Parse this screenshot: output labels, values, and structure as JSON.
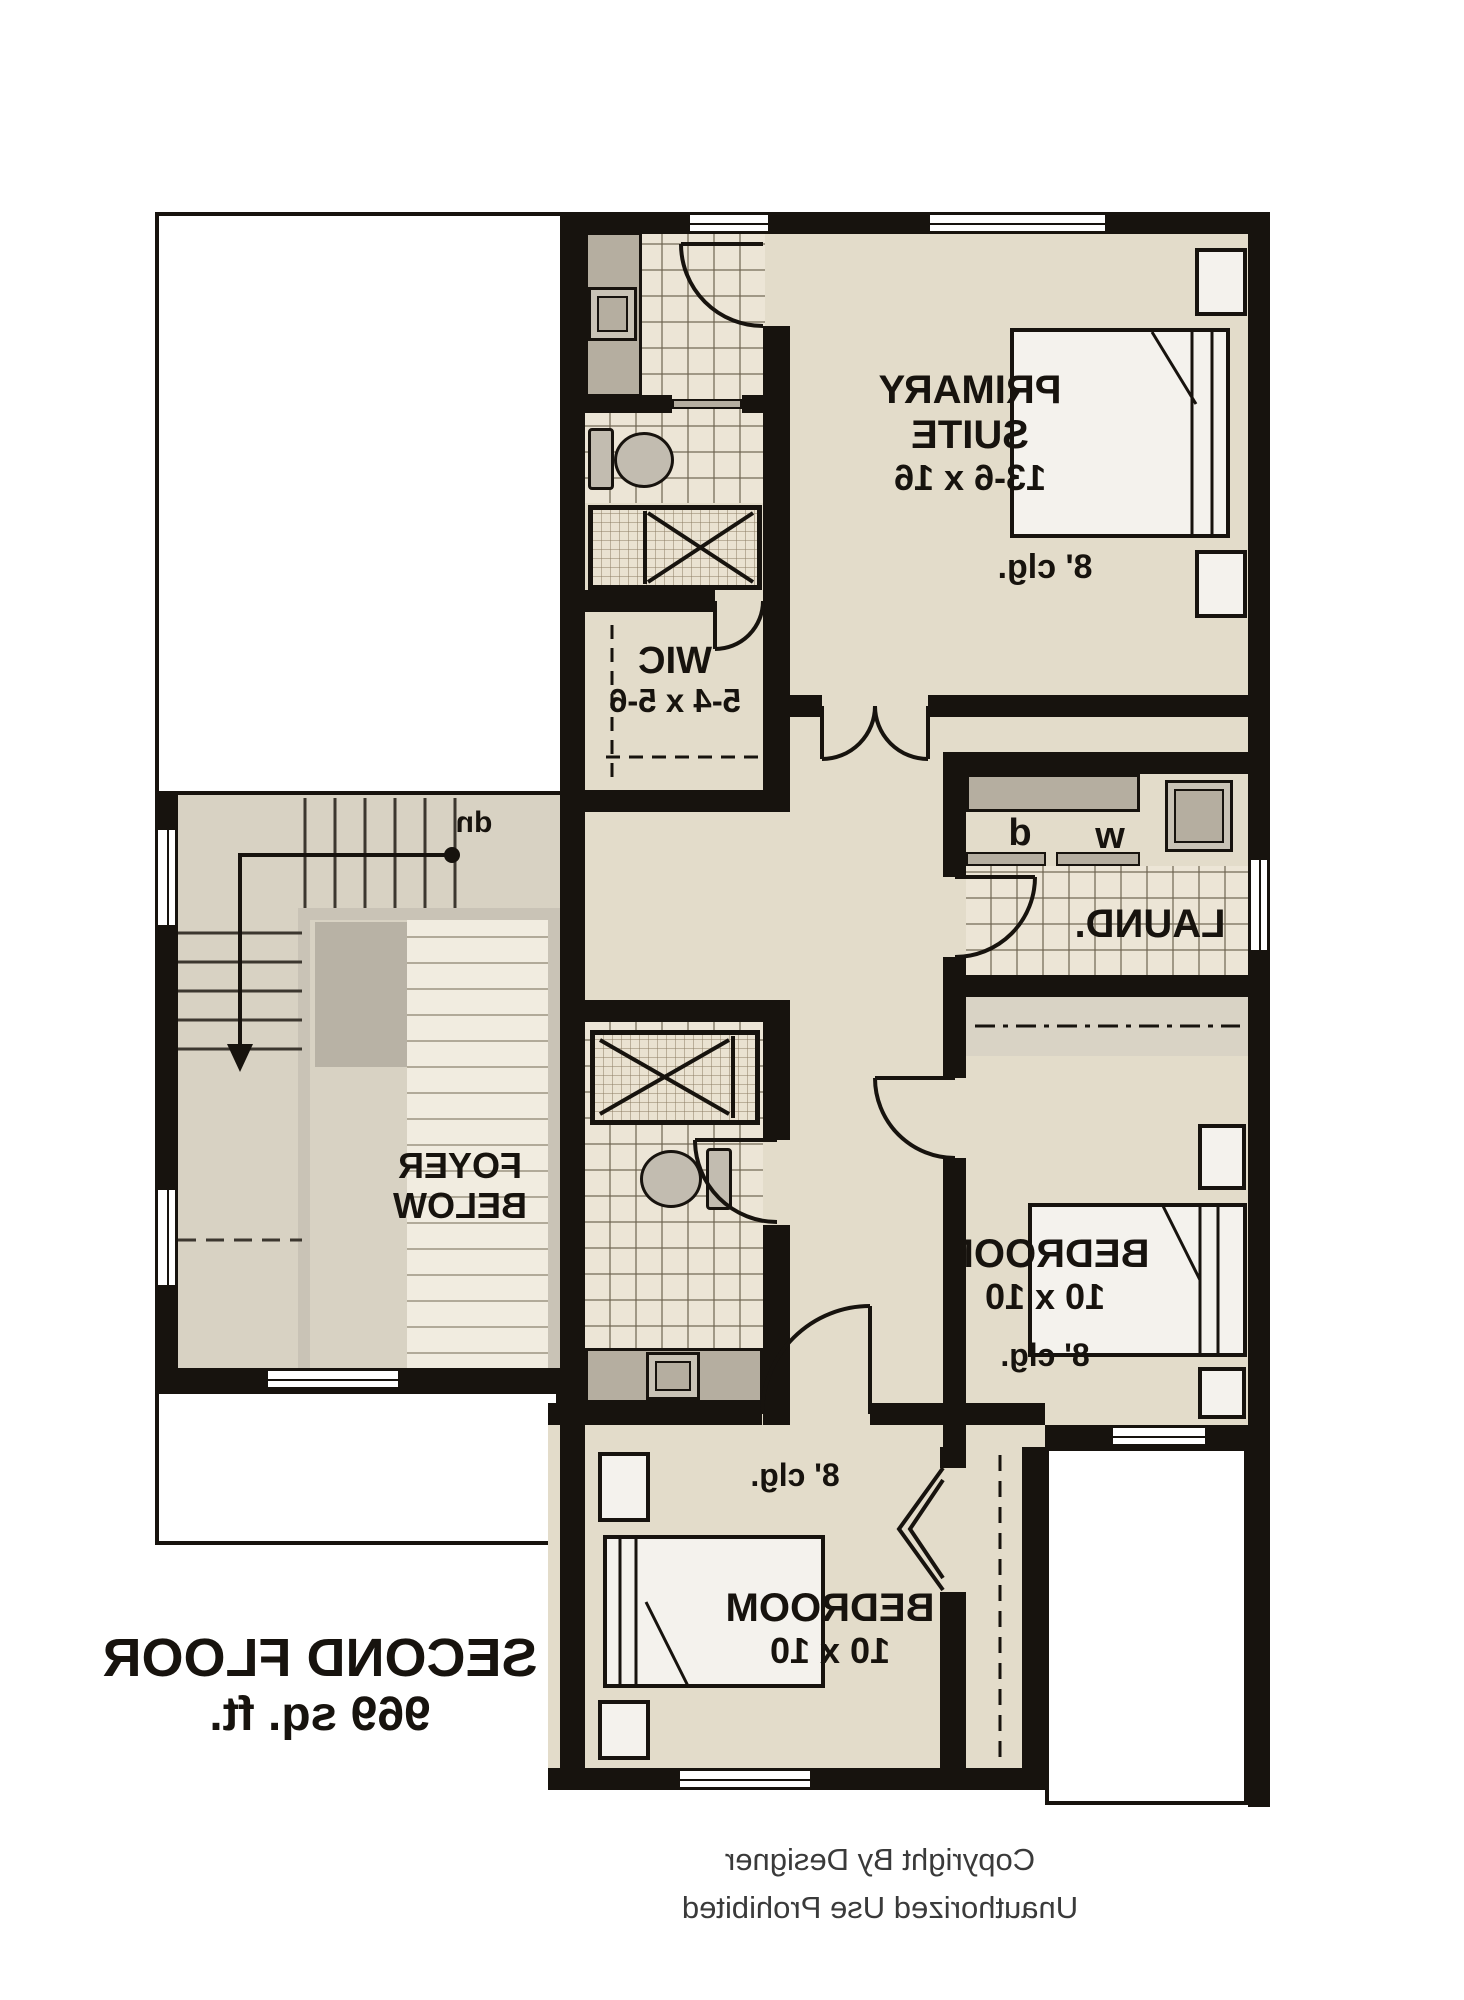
{
  "plan": {
    "floor_label": "SECOND FLOOR",
    "floor_area": "969 sq. ft.",
    "copyright_line1": "Copyright By Designer",
    "copyright_line2": "Unauthorized Use Prohibited",
    "rooms": {
      "primary_suite": {
        "line1": "PRIMARY",
        "line2": "SUITE",
        "dims": "13-6 x 16",
        "ceiling": "8' clg."
      },
      "wic": {
        "label": "WIC",
        "dims": "5-4 x 5-6"
      },
      "laundry": {
        "label": "LAUND.",
        "washer": "w",
        "dryer": "d"
      },
      "foyer": {
        "line1": "FOYER",
        "line2": "BELOW"
      },
      "bedroom_right": {
        "label": "BEDROOM",
        "dims": "10 x 10",
        "ceiling": "8' clg."
      },
      "bedroom_bottom": {
        "label": "BEDROOM",
        "dims": "10 x 10",
        "ceiling": "8' clg."
      },
      "stair": {
        "label": "dn"
      }
    },
    "colors": {
      "wall": "#17130e",
      "floor_beige": "#e3dcca",
      "stair_gray": "#d8d2c3",
      "tile": "#ece5d6",
      "counter_gray": "#b5aea0",
      "background": "#ffffff"
    }
  }
}
